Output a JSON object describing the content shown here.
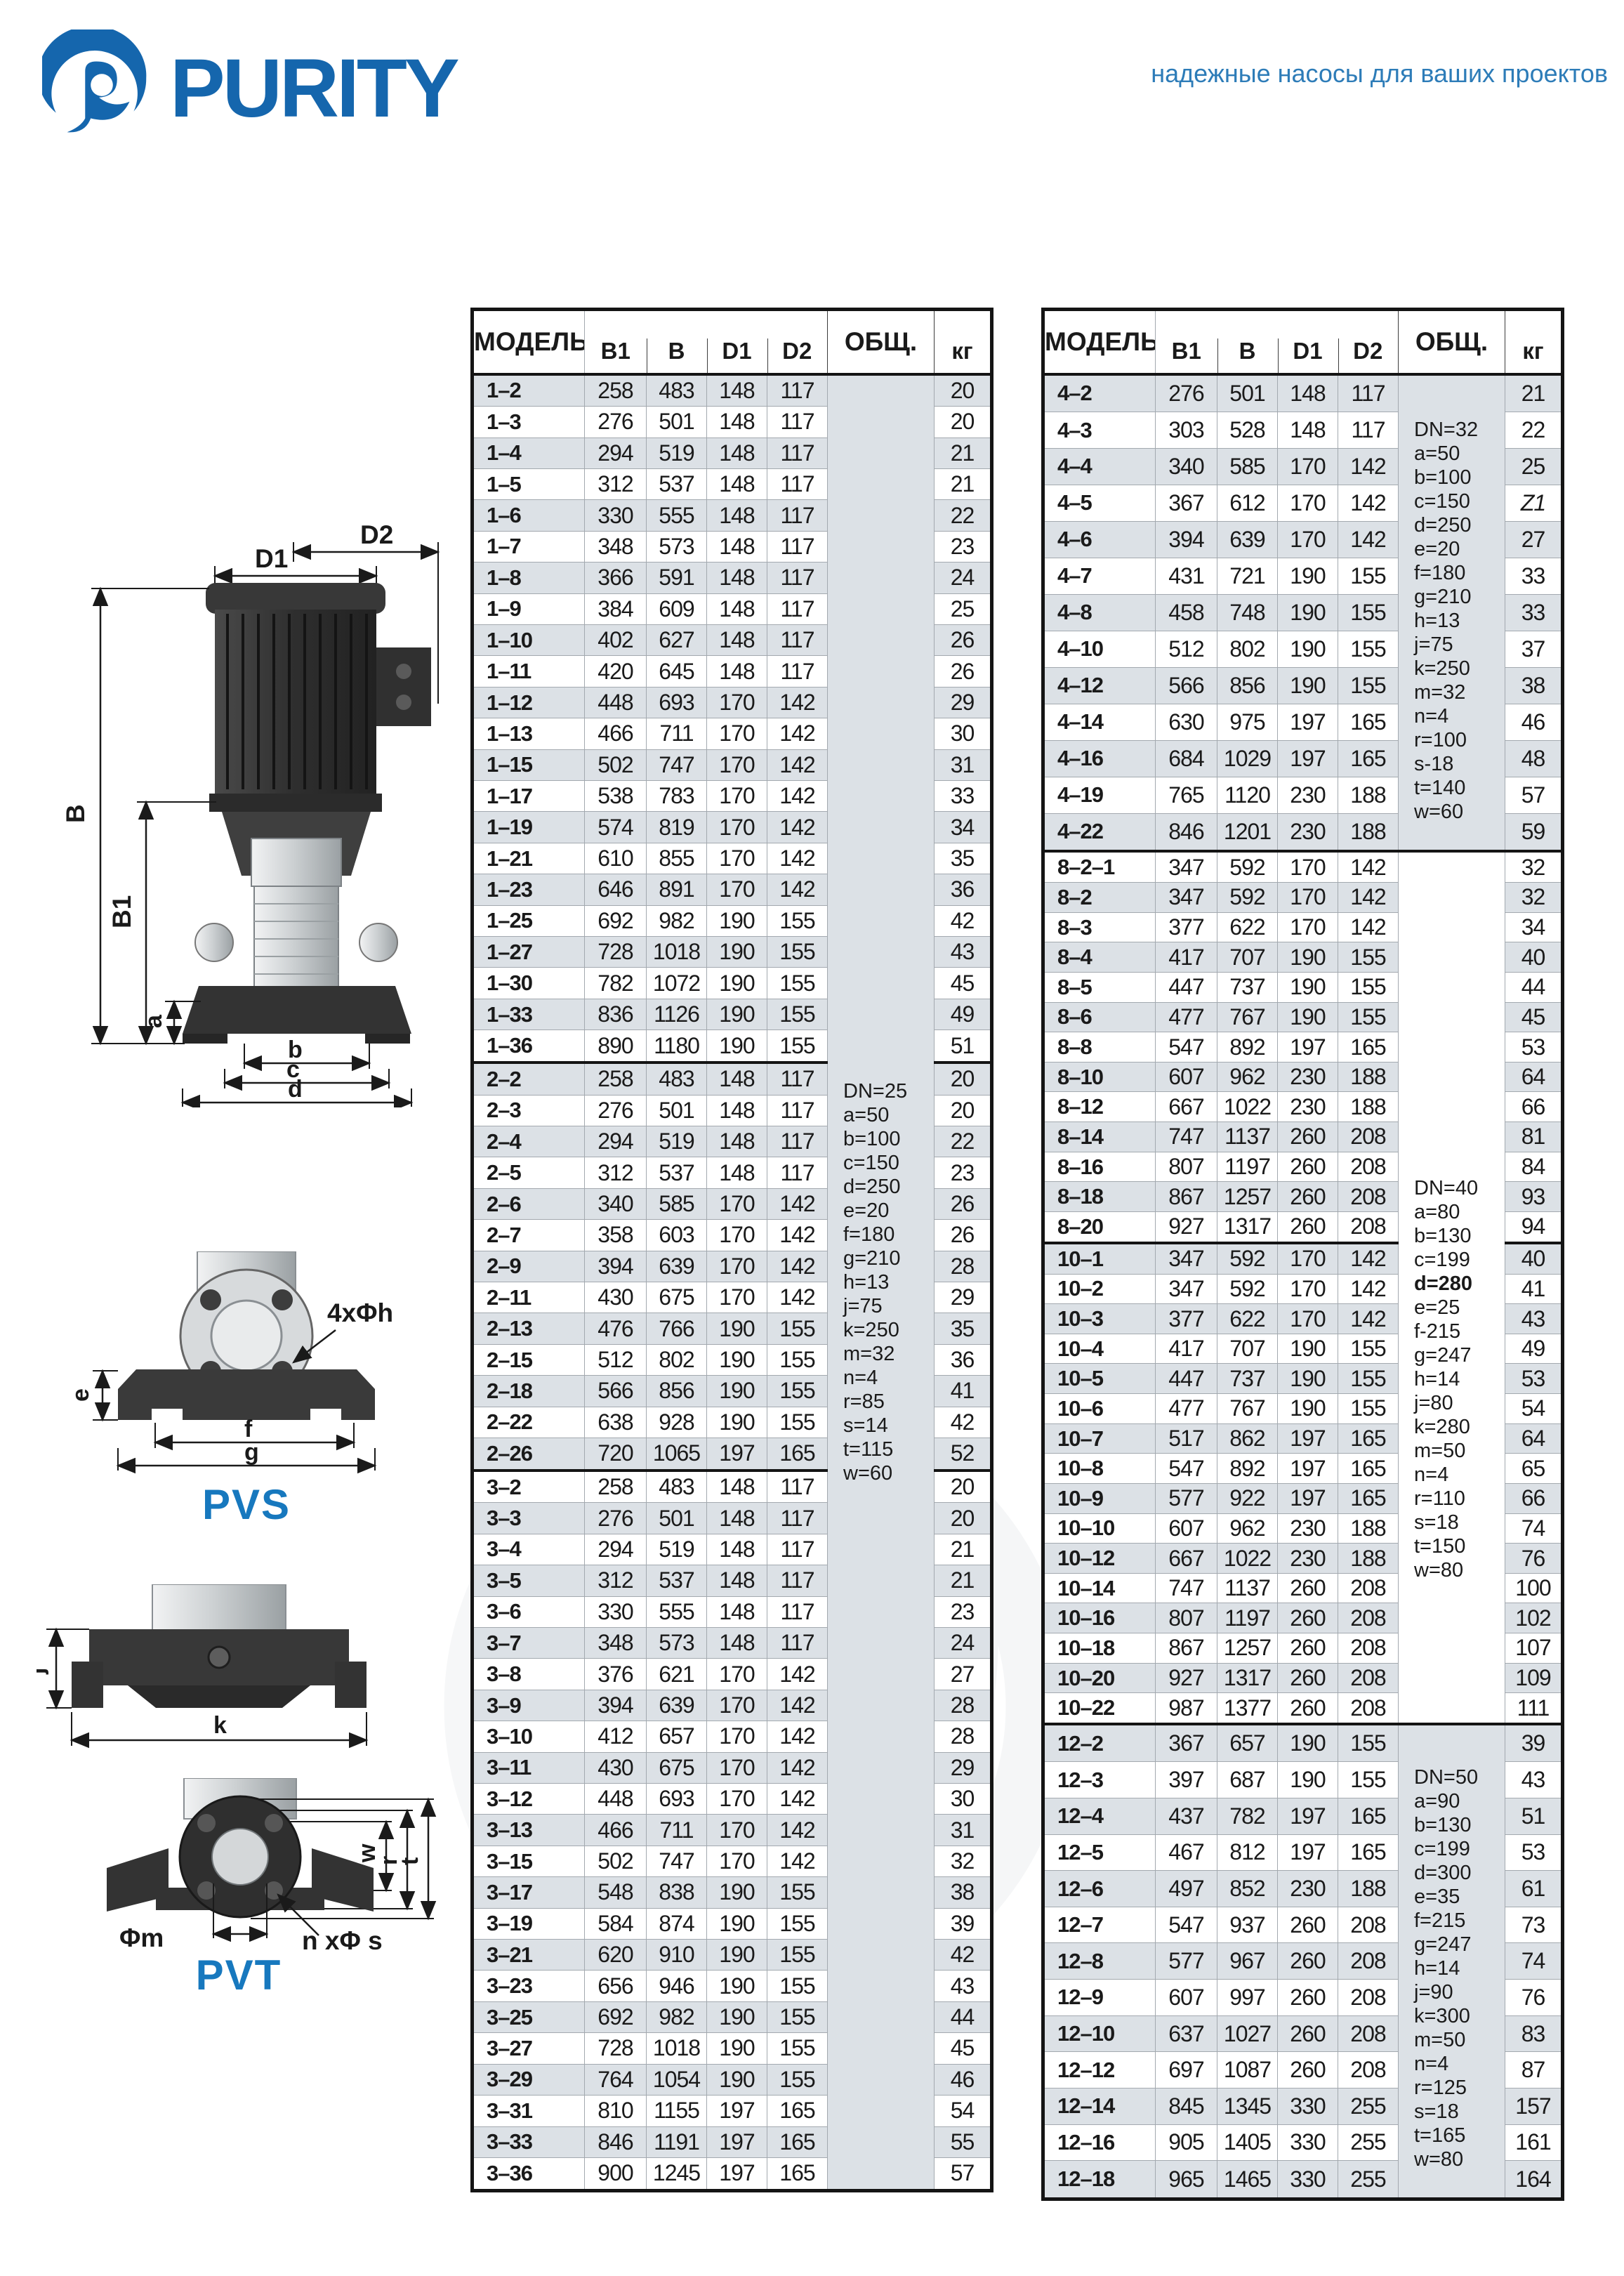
{
  "page": {
    "brand": "PURITY",
    "tagline": "надежные насосы для ваших проектов"
  },
  "colors": {
    "brand_blue": "#1566ad",
    "tagline_blue": "#2d7cb8",
    "series_blue": "#1778be",
    "row_gray": "#dce1e6",
    "border_dark": "#141414",
    "border_light": "#a3a9af"
  },
  "table_headers": {
    "model": "МОДЕЛЬ",
    "b1": "B1",
    "b": "B",
    "d1": "D1",
    "d2": "D2",
    "obshch": "ОБЩ.",
    "kg": "кг"
  },
  "diagram_labels": {
    "d1": "D1",
    "d2": "D2",
    "b_dim": "B",
    "b1_dim": "B1",
    "a": "a",
    "b_small": "b",
    "c_small": "c",
    "d_small": "d",
    "e": "e",
    "bolt4": "4xΦh",
    "f": "f",
    "g": "g",
    "pvs": "PVS",
    "j": "j",
    "k": "k",
    "w": "w",
    "r": "r",
    "t": "t",
    "phi_m": "Φm",
    "n_phi_s": "n xΦ s",
    "pvt": "PVT"
  },
  "left_table": {
    "rows": [
      {
        "m": "1–2",
        "b1": "258",
        "b": "483",
        "d1": "148",
        "d2": "117",
        "kg": "20"
      },
      {
        "m": "1–3",
        "b1": "276",
        "b": "501",
        "d1": "148",
        "d2": "117",
        "kg": "20"
      },
      {
        "m": "1–4",
        "b1": "294",
        "b": "519",
        "d1": "148",
        "d2": "117",
        "kg": "21"
      },
      {
        "m": "1–5",
        "b1": "312",
        "b": "537",
        "d1": "148",
        "d2": "117",
        "kg": "21"
      },
      {
        "m": "1–6",
        "b1": "330",
        "b": "555",
        "d1": "148",
        "d2": "117",
        "kg": "22"
      },
      {
        "m": "1–7",
        "b1": "348",
        "b": "573",
        "d1": "148",
        "d2": "117",
        "kg": "23"
      },
      {
        "m": "1–8",
        "b1": "366",
        "b": "591",
        "d1": "148",
        "d2": "117",
        "kg": "24"
      },
      {
        "m": "1–9",
        "b1": "384",
        "b": "609",
        "d1": "148",
        "d2": "117",
        "kg": "25"
      },
      {
        "m": "1–10",
        "b1": "402",
        "b": "627",
        "d1": "148",
        "d2": "117",
        "kg": "26"
      },
      {
        "m": "1–11",
        "b1": "420",
        "b": "645",
        "d1": "148",
        "d2": "117",
        "kg": "26"
      },
      {
        "m": "1–12",
        "b1": "448",
        "b": "693",
        "d1": "170",
        "d2": "142",
        "kg": "29"
      },
      {
        "m": "1–13",
        "b1": "466",
        "b": "711",
        "d1": "170",
        "d2": "142",
        "kg": "30"
      },
      {
        "m": "1–15",
        "b1": "502",
        "b": "747",
        "d1": "170",
        "d2": "142",
        "kg": "31"
      },
      {
        "m": "1–17",
        "b1": "538",
        "b": "783",
        "d1": "170",
        "d2": "142",
        "kg": "33"
      },
      {
        "m": "1–19",
        "b1": "574",
        "b": "819",
        "d1": "170",
        "d2": "142",
        "kg": "34"
      },
      {
        "m": "1–21",
        "b1": "610",
        "b": "855",
        "d1": "170",
        "d2": "142",
        "kg": "35"
      },
      {
        "m": "1–23",
        "b1": "646",
        "b": "891",
        "d1": "170",
        "d2": "142",
        "kg": "36"
      },
      {
        "m": "1–25",
        "b1": "692",
        "b": "982",
        "d1": "190",
        "d2": "155",
        "kg": "42"
      },
      {
        "m": "1–27",
        "b1": "728",
        "b": "1018",
        "d1": "190",
        "d2": "155",
        "kg": "43"
      },
      {
        "m": "1–30",
        "b1": "782",
        "b": "1072",
        "d1": "190",
        "d2": "155",
        "kg": "45"
      },
      {
        "m": "1–33",
        "b1": "836",
        "b": "1126",
        "d1": "190",
        "d2": "155",
        "kg": "49"
      },
      {
        "m": "1–36",
        "b1": "890",
        "b": "1180",
        "d1": "190",
        "d2": "155",
        "kg": "51"
      },
      {
        "m": "2–2",
        "b1": "258",
        "b": "483",
        "d1": "148",
        "d2": "117",
        "kg": "20",
        "gs": 1
      },
      {
        "m": "2–3",
        "b1": "276",
        "b": "501",
        "d1": "148",
        "d2": "117",
        "kg": "20"
      },
      {
        "m": "2–4",
        "b1": "294",
        "b": "519",
        "d1": "148",
        "d2": "117",
        "kg": "22"
      },
      {
        "m": "2–5",
        "b1": "312",
        "b": "537",
        "d1": "148",
        "d2": "117",
        "kg": "23"
      },
      {
        "m": "2–6",
        "b1": "340",
        "b": "585",
        "d1": "170",
        "d2": "142",
        "kg": "26"
      },
      {
        "m": "2–7",
        "b1": "358",
        "b": "603",
        "d1": "170",
        "d2": "142",
        "kg": "26"
      },
      {
        "m": "2–9",
        "b1": "394",
        "b": "639",
        "d1": "170",
        "d2": "142",
        "kg": "28"
      },
      {
        "m": "2–11",
        "b1": "430",
        "b": "675",
        "d1": "170",
        "d2": "142",
        "kg": "29"
      },
      {
        "m": "2–13",
        "b1": "476",
        "b": "766",
        "d1": "190",
        "d2": "155",
        "kg": "35"
      },
      {
        "m": "2–15",
        "b1": "512",
        "b": "802",
        "d1": "190",
        "d2": "155",
        "kg": "36"
      },
      {
        "m": "2–18",
        "b1": "566",
        "b": "856",
        "d1": "190",
        "d2": "155",
        "kg": "41"
      },
      {
        "m": "2–22",
        "b1": "638",
        "b": "928",
        "d1": "190",
        "d2": "155",
        "kg": "42"
      },
      {
        "m": "2–26",
        "b1": "720",
        "b": "1065",
        "d1": "197",
        "d2": "165",
        "kg": "52"
      },
      {
        "m": "3–2",
        "b1": "258",
        "b": "483",
        "d1": "148",
        "d2": "117",
        "kg": "20",
        "gs": 1
      },
      {
        "m": "3–3",
        "b1": "276",
        "b": "501",
        "d1": "148",
        "d2": "117",
        "kg": "20"
      },
      {
        "m": "3–4",
        "b1": "294",
        "b": "519",
        "d1": "148",
        "d2": "117",
        "kg": "21"
      },
      {
        "m": "3–5",
        "b1": "312",
        "b": "537",
        "d1": "148",
        "d2": "117",
        "kg": "21"
      },
      {
        "m": "3–6",
        "b1": "330",
        "b": "555",
        "d1": "148",
        "d2": "117",
        "kg": "23"
      },
      {
        "m": "3–7",
        "b1": "348",
        "b": "573",
        "d1": "148",
        "d2": "117",
        "kg": "24"
      },
      {
        "m": "3–8",
        "b1": "376",
        "b": "621",
        "d1": "170",
        "d2": "142",
        "kg": "27"
      },
      {
        "m": "3–9",
        "b1": "394",
        "b": "639",
        "d1": "170",
        "d2": "142",
        "kg": "28"
      },
      {
        "m": "3–10",
        "b1": "412",
        "b": "657",
        "d1": "170",
        "d2": "142",
        "kg": "28"
      },
      {
        "m": "3–11",
        "b1": "430",
        "b": "675",
        "d1": "170",
        "d2": "142",
        "kg": "29"
      },
      {
        "m": "3–12",
        "b1": "448",
        "b": "693",
        "d1": "170",
        "d2": "142",
        "kg": "30"
      },
      {
        "m": "3–13",
        "b1": "466",
        "b": "711",
        "d1": "170",
        "d2": "142",
        "kg": "31"
      },
      {
        "m": "3–15",
        "b1": "502",
        "b": "747",
        "d1": "170",
        "d2": "142",
        "kg": "32"
      },
      {
        "m": "3–17",
        "b1": "548",
        "b": "838",
        "d1": "190",
        "d2": "155",
        "kg": "38"
      },
      {
        "m": "3–19",
        "b1": "584",
        "b": "874",
        "d1": "190",
        "d2": "155",
        "kg": "39"
      },
      {
        "m": "3–21",
        "b1": "620",
        "b": "910",
        "d1": "190",
        "d2": "155",
        "kg": "42"
      },
      {
        "m": "3–23",
        "b1": "656",
        "b": "946",
        "d1": "190",
        "d2": "155",
        "kg": "43"
      },
      {
        "m": "3–25",
        "b1": "692",
        "b": "982",
        "d1": "190",
        "d2": "155",
        "kg": "44"
      },
      {
        "m": "3–27",
        "b1": "728",
        "b": "1018",
        "d1": "190",
        "d2": "155",
        "kg": "45"
      },
      {
        "m": "3–29",
        "b1": "764",
        "b": "1054",
        "d1": "190",
        "d2": "155",
        "kg": "46"
      },
      {
        "m": "3–31",
        "b1": "810",
        "b": "1155",
        "d1": "197",
        "d2": "165",
        "kg": "54"
      },
      {
        "m": "3–33",
        "b1": "846",
        "b": "1191",
        "d1": "197",
        "d2": "165",
        "kg": "55"
      },
      {
        "m": "3–36",
        "b1": "900",
        "b": "1245",
        "d1": "197",
        "d2": "165",
        "kg": "57"
      }
    ],
    "obshch": [
      {
        "start": 0,
        "span": 58,
        "mt": 0,
        "lines": [
          "DN=25",
          "a=50",
          "b=100",
          "c=150",
          "d=250",
          "e=20",
          "f=180",
          "g=210",
          "h=13",
          "j=75",
          "k=250",
          "m=32",
          "n=4",
          "r=85",
          "s=14",
          "t=115",
          "w=60"
        ]
      }
    ]
  },
  "right_table": {
    "rows": [
      {
        "m": "4–2",
        "b1": "276",
        "b": "501",
        "d1": "148",
        "d2": "117",
        "kg": "21"
      },
      {
        "m": "4–3",
        "b1": "303",
        "b": "528",
        "d1": "148",
        "d2": "117",
        "kg": "22"
      },
      {
        "m": "4–4",
        "b1": "340",
        "b": "585",
        "d1": "170",
        "d2": "142",
        "kg": "25"
      },
      {
        "m": "4–5",
        "b1": "367",
        "b": "612",
        "d1": "170",
        "d2": "142",
        "kg": "Z1",
        "ki": 1
      },
      {
        "m": "4–6",
        "b1": "394",
        "b": "639",
        "d1": "170",
        "d2": "142",
        "kg": "27"
      },
      {
        "m": "4–7",
        "b1": "431",
        "b": "721",
        "d1": "190",
        "d2": "155",
        "kg": "33"
      },
      {
        "m": "4–8",
        "b1": "458",
        "b": "748",
        "d1": "190",
        "d2": "155",
        "kg": "33"
      },
      {
        "m": "4–10",
        "b1": "512",
        "b": "802",
        "d1": "190",
        "d2": "155",
        "kg": "37"
      },
      {
        "m": "4–12",
        "b1": "566",
        "b": "856",
        "d1": "190",
        "d2": "155",
        "kg": "38"
      },
      {
        "m": "4–14",
        "b1": "630",
        "b": "975",
        "d1": "197",
        "d2": "165",
        "kg": "46"
      },
      {
        "m": "4–16",
        "b1": "684",
        "b": "1029",
        "d1": "197",
        "d2": "165",
        "kg": "48"
      },
      {
        "m": "4–19",
        "b1": "765",
        "b": "1120",
        "d1": "230",
        "d2": "188",
        "kg": "57"
      },
      {
        "m": "4–22",
        "b1": "846",
        "b": "1201",
        "d1": "230",
        "d2": "188",
        "kg": "59"
      },
      {
        "m": "8–2–1",
        "b1": "347",
        "b": "592",
        "d1": "170",
        "d2": "142",
        "kg": "32",
        "gs": 1
      },
      {
        "m": "8–2",
        "b1": "347",
        "b": "592",
        "d1": "170",
        "d2": "142",
        "kg": "32"
      },
      {
        "m": "8–3",
        "b1": "377",
        "b": "622",
        "d1": "170",
        "d2": "142",
        "kg": "34"
      },
      {
        "m": "8–4",
        "b1": "417",
        "b": "707",
        "d1": "190",
        "d2": "155",
        "kg": "40"
      },
      {
        "m": "8–5",
        "b1": "447",
        "b": "737",
        "d1": "190",
        "d2": "155",
        "kg": "44"
      },
      {
        "m": "8–6",
        "b1": "477",
        "b": "767",
        "d1": "190",
        "d2": "155",
        "kg": "45"
      },
      {
        "m": "8–8",
        "b1": "547",
        "b": "892",
        "d1": "197",
        "d2": "165",
        "kg": "53"
      },
      {
        "m": "8–10",
        "b1": "607",
        "b": "962",
        "d1": "230",
        "d2": "188",
        "kg": "64"
      },
      {
        "m": "8–12",
        "b1": "667",
        "b": "1022",
        "d1": "230",
        "d2": "188",
        "kg": "66"
      },
      {
        "m": "8–14",
        "b1": "747",
        "b": "1137",
        "d1": "260",
        "d2": "208",
        "kg": "81"
      },
      {
        "m": "8–16",
        "b1": "807",
        "b": "1197",
        "d1": "260",
        "d2": "208",
        "kg": "84"
      },
      {
        "m": "8–18",
        "b1": "867",
        "b": "1257",
        "d1": "260",
        "d2": "208",
        "kg": "93"
      },
      {
        "m": "8–20",
        "b1": "927",
        "b": "1317",
        "d1": "260",
        "d2": "208",
        "kg": "94"
      },
      {
        "m": "10–1",
        "b1": "347",
        "b": "592",
        "d1": "170",
        "d2": "142",
        "kg": "40",
        "gs": 1
      },
      {
        "m": "10–2",
        "b1": "347",
        "b": "592",
        "d1": "170",
        "d2": "142",
        "kg": "41"
      },
      {
        "m": "10–3",
        "b1": "377",
        "b": "622",
        "d1": "170",
        "d2": "142",
        "kg": "43"
      },
      {
        "m": "10–4",
        "b1": "417",
        "b": "707",
        "d1": "190",
        "d2": "155",
        "kg": "49"
      },
      {
        "m": "10–5",
        "b1": "447",
        "b": "737",
        "d1": "190",
        "d2": "155",
        "kg": "53"
      },
      {
        "m": "10–6",
        "b1": "477",
        "b": "767",
        "d1": "190",
        "d2": "155",
        "kg": "54"
      },
      {
        "m": "10–7",
        "b1": "517",
        "b": "862",
        "d1": "197",
        "d2": "165",
        "kg": "64"
      },
      {
        "m": "10–8",
        "b1": "547",
        "b": "892",
        "d1": "197",
        "d2": "165",
        "kg": "65"
      },
      {
        "m": "10–9",
        "b1": "577",
        "b": "922",
        "d1": "197",
        "d2": "165",
        "kg": "66"
      },
      {
        "m": "10–10",
        "b1": "607",
        "b": "962",
        "d1": "230",
        "d2": "188",
        "kg": "74"
      },
      {
        "m": "10–12",
        "b1": "667",
        "b": "1022",
        "d1": "230",
        "d2": "188",
        "kg": "76"
      },
      {
        "m": "10–14",
        "b1": "747",
        "b": "1137",
        "d1": "260",
        "d2": "208",
        "kg": "100"
      },
      {
        "m": "10–16",
        "b1": "807",
        "b": "1197",
        "d1": "260",
        "d2": "208",
        "kg": "102"
      },
      {
        "m": "10–18",
        "b1": "867",
        "b": "1257",
        "d1": "260",
        "d2": "208",
        "kg": "107"
      },
      {
        "m": "10–20",
        "b1": "927",
        "b": "1317",
        "d1": "260",
        "d2": "208",
        "kg": "109"
      },
      {
        "m": "10–22",
        "b1": "987",
        "b": "1377",
        "d1": "260",
        "d2": "208",
        "kg": "111"
      },
      {
        "m": "12–2",
        "b1": "367",
        "b": "657",
        "d1": "190",
        "d2": "155",
        "kg": "39",
        "gs": 1
      },
      {
        "m": "12–3",
        "b1": "397",
        "b": "687",
        "d1": "190",
        "d2": "155",
        "kg": "43"
      },
      {
        "m": "12–4",
        "b1": "437",
        "b": "782",
        "d1": "197",
        "d2": "165",
        "kg": "51"
      },
      {
        "m": "12–5",
        "b1": "467",
        "b": "812",
        "d1": "197",
        "d2": "165",
        "kg": "53"
      },
      {
        "m": "12–6",
        "b1": "497",
        "b": "852",
        "d1": "230",
        "d2": "188",
        "kg": "61"
      },
      {
        "m": "12–7",
        "b1": "547",
        "b": "937",
        "d1": "260",
        "d2": "208",
        "kg": "73"
      },
      {
        "m": "12–8",
        "b1": "577",
        "b": "967",
        "d1": "260",
        "d2": "208",
        "kg": "74"
      },
      {
        "m": "12–9",
        "b1": "607",
        "b": "997",
        "d1": "260",
        "d2": "208",
        "kg": "76"
      },
      {
        "m": "12–10",
        "b1": "637",
        "b": "1027",
        "d1": "260",
        "d2": "208",
        "kg": "83"
      },
      {
        "m": "12–12",
        "b1": "697",
        "b": "1087",
        "d1": "260",
        "d2": "208",
        "kg": "87"
      },
      {
        "m": "12–14",
        "b1": "845",
        "b": "1345",
        "d1": "330",
        "d2": "255",
        "kg": "157"
      },
      {
        "m": "12–16",
        "b1": "905",
        "b": "1405",
        "d1": "330",
        "d2": "255",
        "kg": "161"
      },
      {
        "m": "12–18",
        "b1": "965",
        "b": "1465",
        "d1": "330",
        "d2": "255",
        "kg": "164"
      }
    ],
    "obshch": [
      {
        "start": 0,
        "span": 13,
        "mt": 24,
        "lines": [
          "DN=32",
          "a=50",
          "b=100",
          "c=150",
          "d=250",
          "e=20",
          "f=180",
          "g=210",
          "h=13",
          "j=75",
          "k=250",
          "m=32",
          "n=4",
          "r=100",
          "s-18",
          "t=140",
          "w=60"
        ]
      },
      {
        "start": 13,
        "span": 29,
        "mt": 260,
        "lines": [
          "DN=40",
          "a=80",
          "b=130",
          "c=199",
          {
            "t": "d=280",
            "b": true
          },
          "e=25",
          "f-215",
          "g=247",
          "h=14",
          "j=80",
          "k=280",
          "m=50",
          "n=4",
          "r=110",
          "s=18",
          "t=150",
          "w=80"
        ]
      },
      {
        "start": 42,
        "span": 13,
        "mt": 20,
        "lines": [
          "DN=50",
          "a=90",
          "b=130",
          "c=199",
          "d=300",
          "e=35",
          "f=215",
          "g=247",
          "h=14",
          "j=90",
          "k=300",
          "m=50",
          "n=4",
          "r=125",
          "s=18",
          "t=165",
          "w=80"
        ]
      }
    ]
  }
}
